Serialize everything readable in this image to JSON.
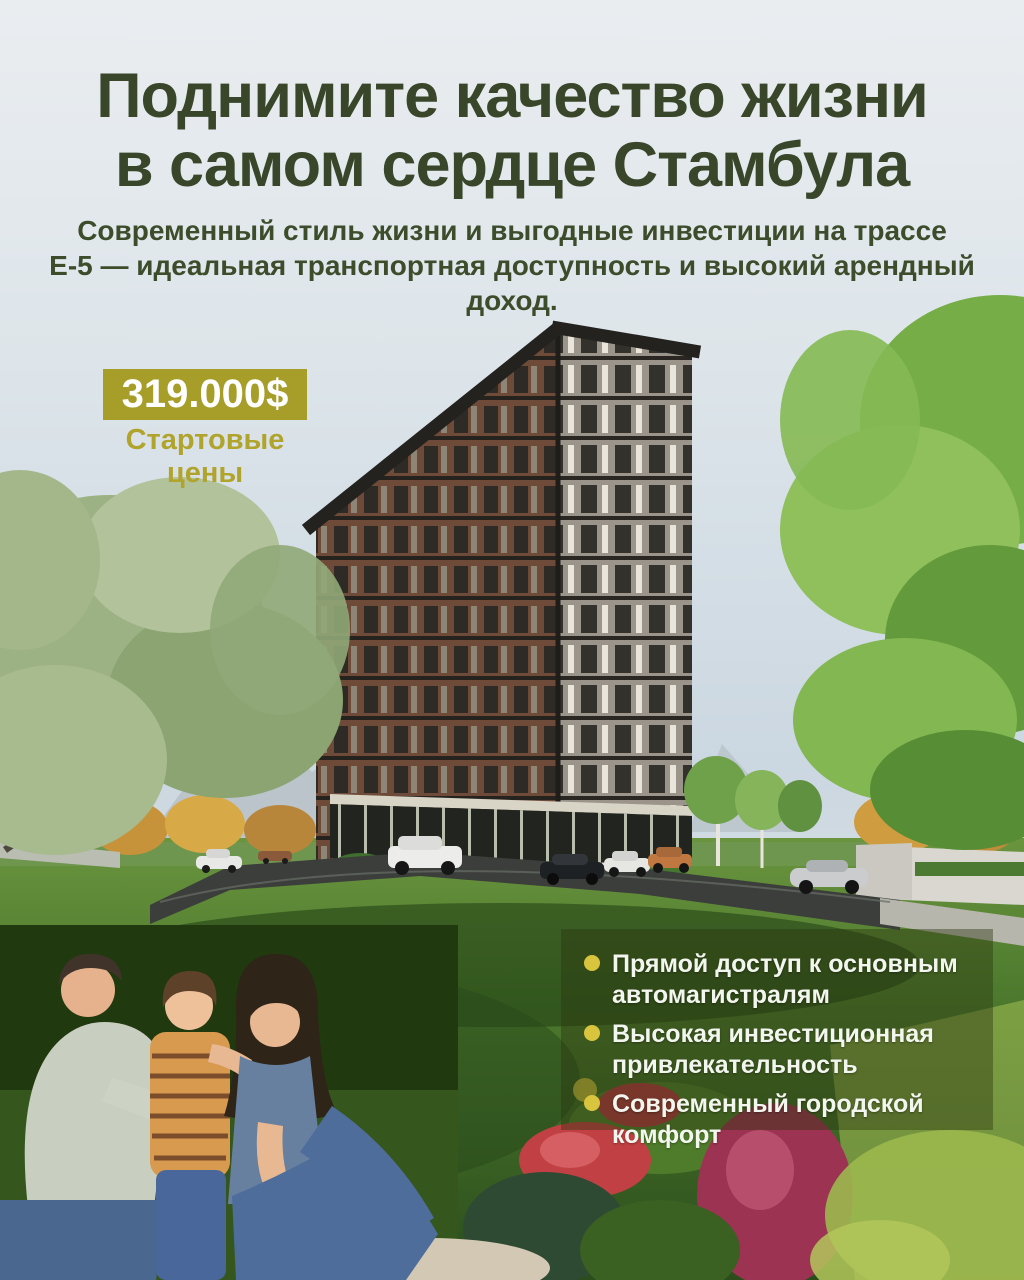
{
  "header": {
    "title_line1": "Поднимите качество жизни",
    "title_line2": "в самом сердце Стамбула",
    "subtitle_line1": "Современный стиль жизни и выгодные инвестиции на трассе",
    "subtitle_line2": "Е-5 — идеальная транспортная доступность и высокий арендный доход."
  },
  "price": {
    "amount": "319.000$",
    "caption": "Стартовые цены"
  },
  "features": {
    "items": [
      "Прямой доступ к основным автомагистралям",
      "Высокая инвестиционная привлекательность",
      "Современный городской комфорт"
    ]
  },
  "colors": {
    "title_green": "#39462a",
    "badge_gold": "#a79d29",
    "caption_gold": "#b1a42c",
    "bullet_gold": "#d9c43e",
    "feature_text": "#f3f6ee",
    "panel_overlay": "rgba(42,52,14,0.42)",
    "sky_top": "#eaedf0",
    "sky_bottom": "#cbd7e1"
  }
}
